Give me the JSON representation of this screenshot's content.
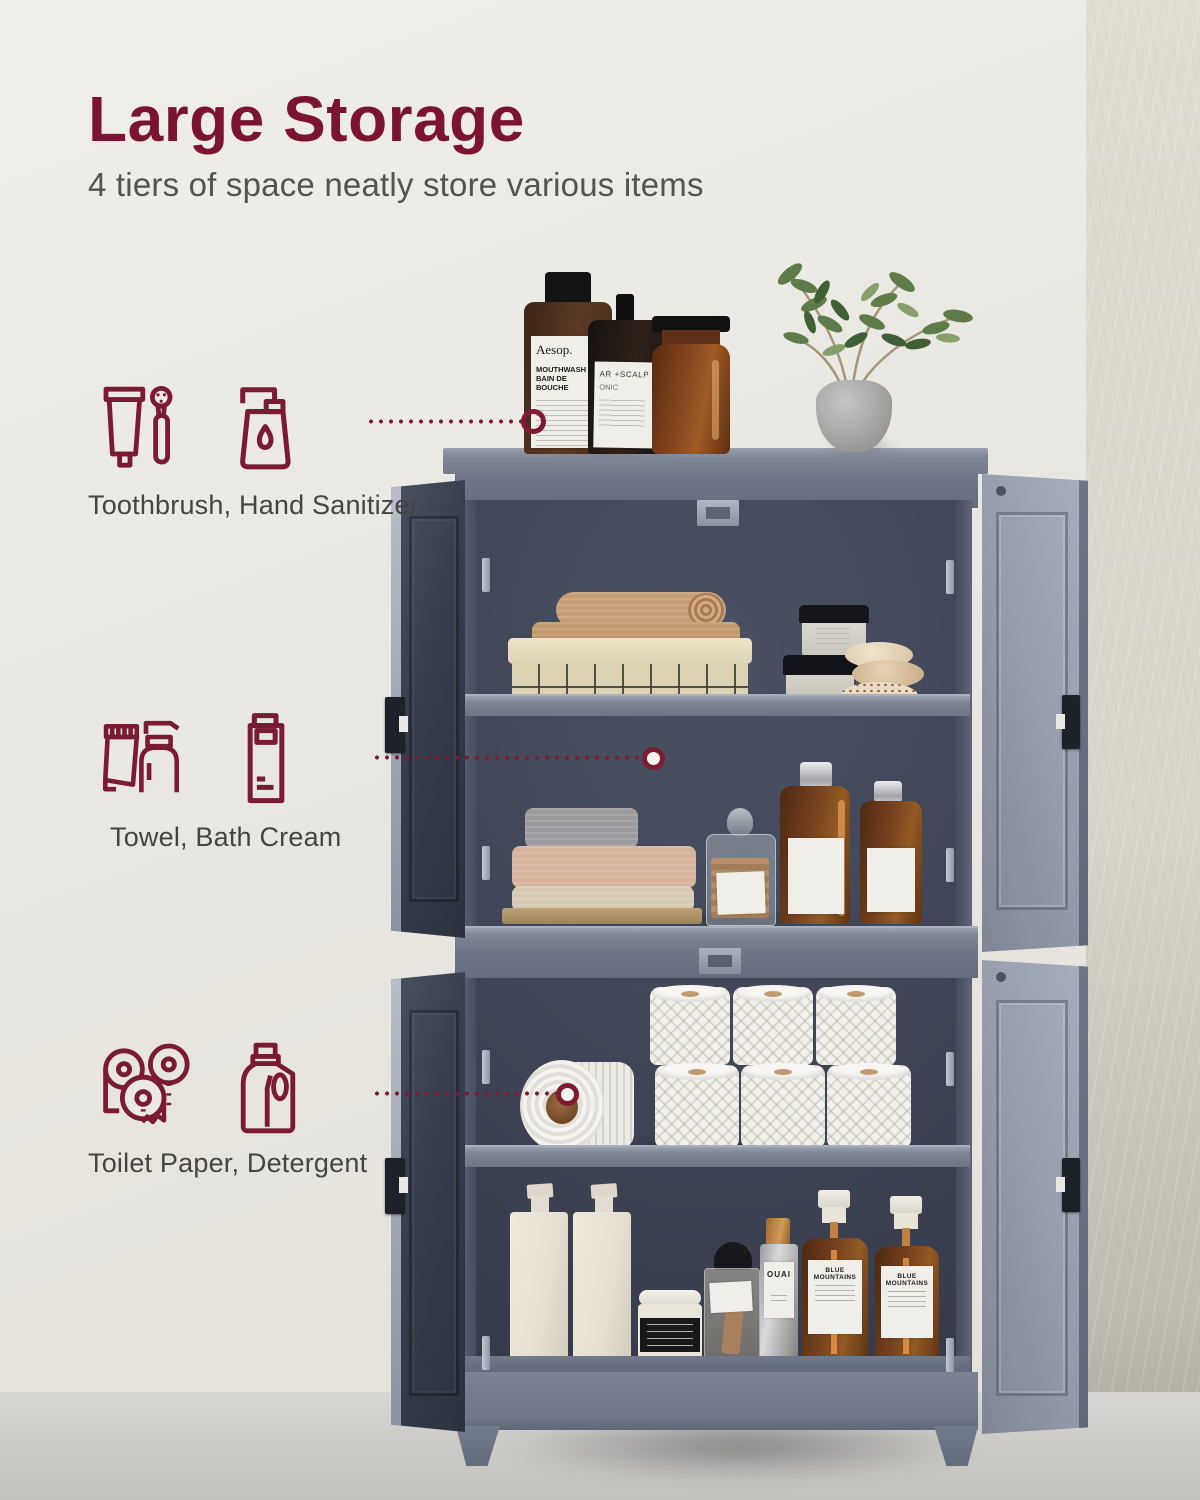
{
  "header": {
    "title": "Large Storage",
    "subtitle": "4 tiers of space neatly store various items"
  },
  "features": [
    {
      "label": "Toothbrush, Hand Sanitizer",
      "icons": [
        "toothpaste-tube-icon",
        "electric-toothbrush-icon",
        "hand-sanitizer-icon"
      ]
    },
    {
      "label": "Towel, Bath Cream",
      "icons": [
        "cream-tube-icon",
        "lotion-pump-bottle-icon",
        "bath-cream-bottle-icon"
      ]
    },
    {
      "label": "Toilet Paper, Detergent",
      "icons": [
        "toilet-paper-rolls-icon",
        "detergent-jug-icon"
      ]
    }
  ],
  "product_labels": {
    "aesop_brand": "Aesop.",
    "aesop_line1": "MOUTHWASH",
    "aesop_line2": "BAIN DE BOUCHE",
    "tonic_line1": "AR +SCALP",
    "tonic_line2": "ONIC",
    "ouai": "OUAI",
    "blue_mountains": "BLUE MOUNTAINS"
  },
  "colors": {
    "accent": "#7B1432",
    "icon_maroon": "#7A1A33",
    "subtitle_text": "#55534E",
    "feature_text": "#45443F",
    "cabinet_gray": "#79818F",
    "cabinet_interior": "#3F4556",
    "wall": "#EAE8E1",
    "floor": "#CBCAC6"
  },
  "scene": {
    "tiers": 4,
    "tier1_items": "towel basket, cream jars, stones",
    "tier2_items": "folded towels, glass jar, amber bottles",
    "tier3_items": "toilet paper rolls",
    "tier4_items": "dispenser bottles, jar, canister"
  }
}
